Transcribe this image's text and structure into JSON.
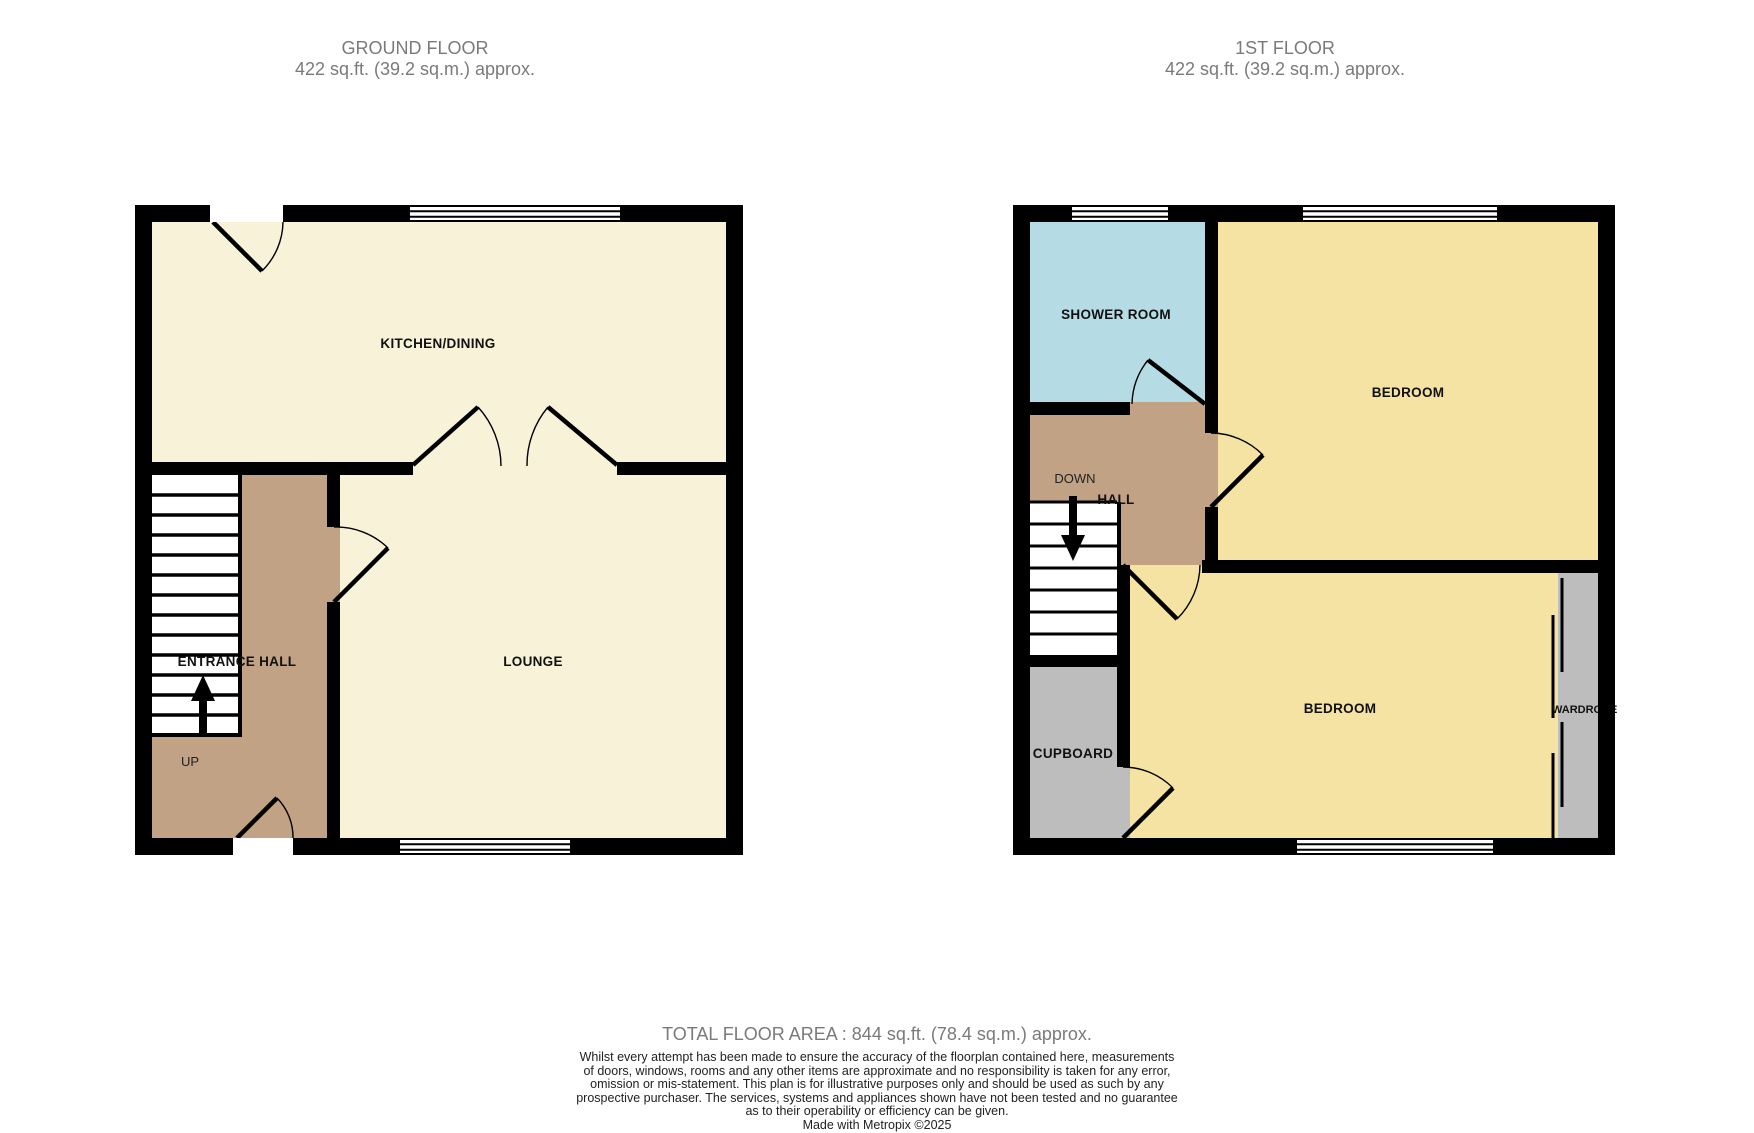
{
  "ground_floor": {
    "title": "GROUND FLOOR",
    "area": "422 sq.ft. (39.2 sq.m.) approx.",
    "rooms": {
      "kitchen_dining": "KITCHEN/DINING",
      "entrance_hall": "ENTRANCE HALL",
      "lounge": "LOUNGE"
    },
    "stairs_label": "UP"
  },
  "first_floor": {
    "title": "1ST FLOOR",
    "area": "422 sq.ft. (39.2 sq.m.) approx.",
    "rooms": {
      "shower_room": "SHOWER ROOM",
      "bedroom_front": "BEDROOM",
      "hall": "HALL",
      "bedroom_back": "BEDROOM",
      "cupboard": "CUPBOARD",
      "wardrobe": "WARDROBE"
    },
    "stairs_label": "DOWN"
  },
  "footer": {
    "total_area": "TOTAL FLOOR AREA : 844 sq.ft. (78.4 sq.m.) approx.",
    "disclaimer_lines": [
      "Whilst every attempt has been made to ensure the accuracy of the floorplan contained here, measurements",
      "of doors, windows, rooms and any other items are approximate and no responsibility is taken for any error,",
      "omission or mis-statement. This plan is for illustrative purposes only and should be used as such by any",
      "prospective purchaser. The services, systems and appliances shown have not been tested and no guarantee",
      "as to their operability or efficiency can be given."
    ],
    "credit": "Made with Metropix ©2025"
  },
  "colors": {
    "lounge": "#f8f2d9",
    "bedroom": "#f5e3a3",
    "hall": "#c2a284",
    "shower": "#b5dce4",
    "storage": "#bdbdbd",
    "stairs": "#ffffff",
    "wall": "#000000",
    "header_text": "#7a7a7a",
    "disclaimer_text": "#222222"
  }
}
